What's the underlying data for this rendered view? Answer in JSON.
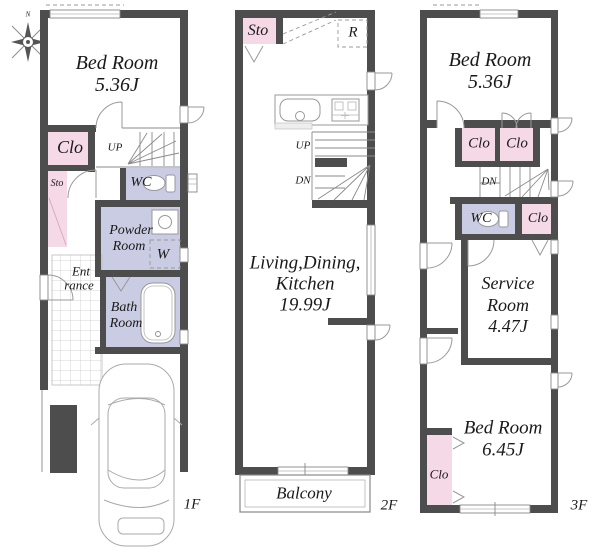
{
  "colors": {
    "wall": "#4d4d4d",
    "pink": "#f6d9e7",
    "lav": "#c9cce3",
    "line": "#999999",
    "text": "#1a1a1a"
  },
  "compass": {
    "north": "N"
  },
  "floor1": {
    "label": "1F",
    "bedroom": {
      "name": "Bed Room",
      "area": "5.36J"
    },
    "closet": "Clo",
    "storage": "Sto",
    "stairs_up": "UP",
    "wc": "WC",
    "powder_room": {
      "line1": "Powder",
      "line2": "Room"
    },
    "washer": "W",
    "bath_room": {
      "line1": "Bath",
      "line2": "Room"
    },
    "entrance": {
      "line1": "Ent",
      "line2": "rance"
    }
  },
  "floor2": {
    "label": "2F",
    "storage": "Sto",
    "refrigerator": "R",
    "stairs_up": "UP",
    "stairs_down": "DN",
    "ldk": {
      "line1": "Living,Dining,",
      "line2": "Kitchen",
      "area": "19.99J"
    },
    "balcony": "Balcony"
  },
  "floor3": {
    "label": "3F",
    "bedroom_north": {
      "name": "Bed Room",
      "area": "5.36J"
    },
    "closet_a": "Clo",
    "closet_b": "Clo",
    "stairs_down": "DN",
    "wc": "WC",
    "closet_c": "Clo",
    "service_room": {
      "line1": "Service",
      "line2": "Room",
      "area": "4.47J"
    },
    "bedroom_south": {
      "name": "Bed Room",
      "area": "6.45J"
    },
    "closet_d": "Clo"
  }
}
